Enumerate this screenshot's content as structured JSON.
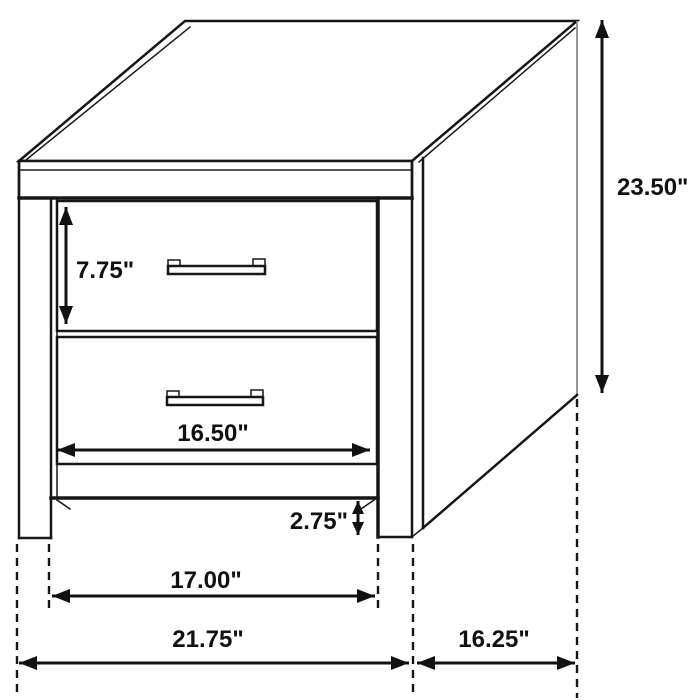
{
  "figure": {
    "subject": "Two-drawer nightstand dimension line drawing",
    "units": "inches"
  },
  "colors": {
    "line": "#161616",
    "background": "#ffffff",
    "back_edge": "#8a8a8a"
  },
  "dims": [
    {
      "name": "drawer-front-height",
      "label": "7.75\""
    },
    {
      "name": "overall-height",
      "label": "23.50\""
    },
    {
      "name": "drawer-width",
      "label": "16.50\""
    },
    {
      "name": "floor-clearance",
      "label": "2.75\""
    },
    {
      "name": "inner-leg-span",
      "label": "17.00\""
    },
    {
      "name": "overall-width",
      "label": "21.75\""
    },
    {
      "name": "overall-depth",
      "label": "16.25\""
    }
  ]
}
